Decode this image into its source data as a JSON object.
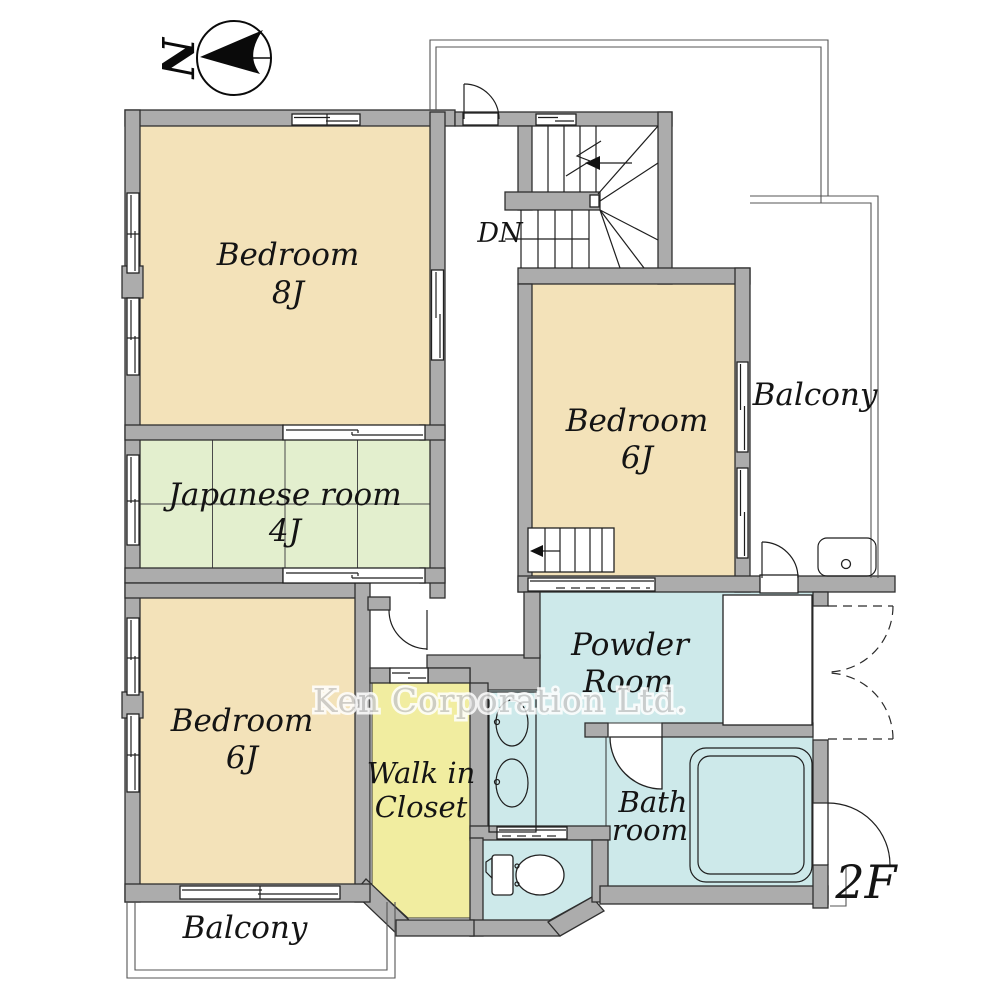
{
  "compass": {
    "north_label": "N"
  },
  "floor_label": "2F",
  "watermark": "Ken Corporation Ltd.",
  "stairs": {
    "direction_label": "DN"
  },
  "rooms": {
    "bedroom_8j": {
      "name": "Bedroom",
      "size": "8J"
    },
    "japanese_room": {
      "name": "Japanese room",
      "size": "4J"
    },
    "bedroom_6j_left": {
      "name": "Bedroom",
      "size": "6J"
    },
    "bedroom_6j_right": {
      "name": "Bedroom",
      "size": "6J"
    },
    "walk_in_closet": {
      "line1": "Walk in",
      "line2": "Closet"
    },
    "powder_room": {
      "line1": "Powder",
      "line2": "Room"
    },
    "bath_room": {
      "line1": "Bath",
      "line2": "room"
    },
    "balcony_right": {
      "name": "Balcony"
    },
    "balcony_bottom": {
      "name": "Balcony"
    }
  },
  "colors": {
    "wall": "#acacac",
    "bedroom": "#f3e2b9",
    "tatami": "#e3efce",
    "wet_area": "#cde9ea",
    "closet": "#f1eda0",
    "fixture_cyan": "#cfeaeb"
  }
}
